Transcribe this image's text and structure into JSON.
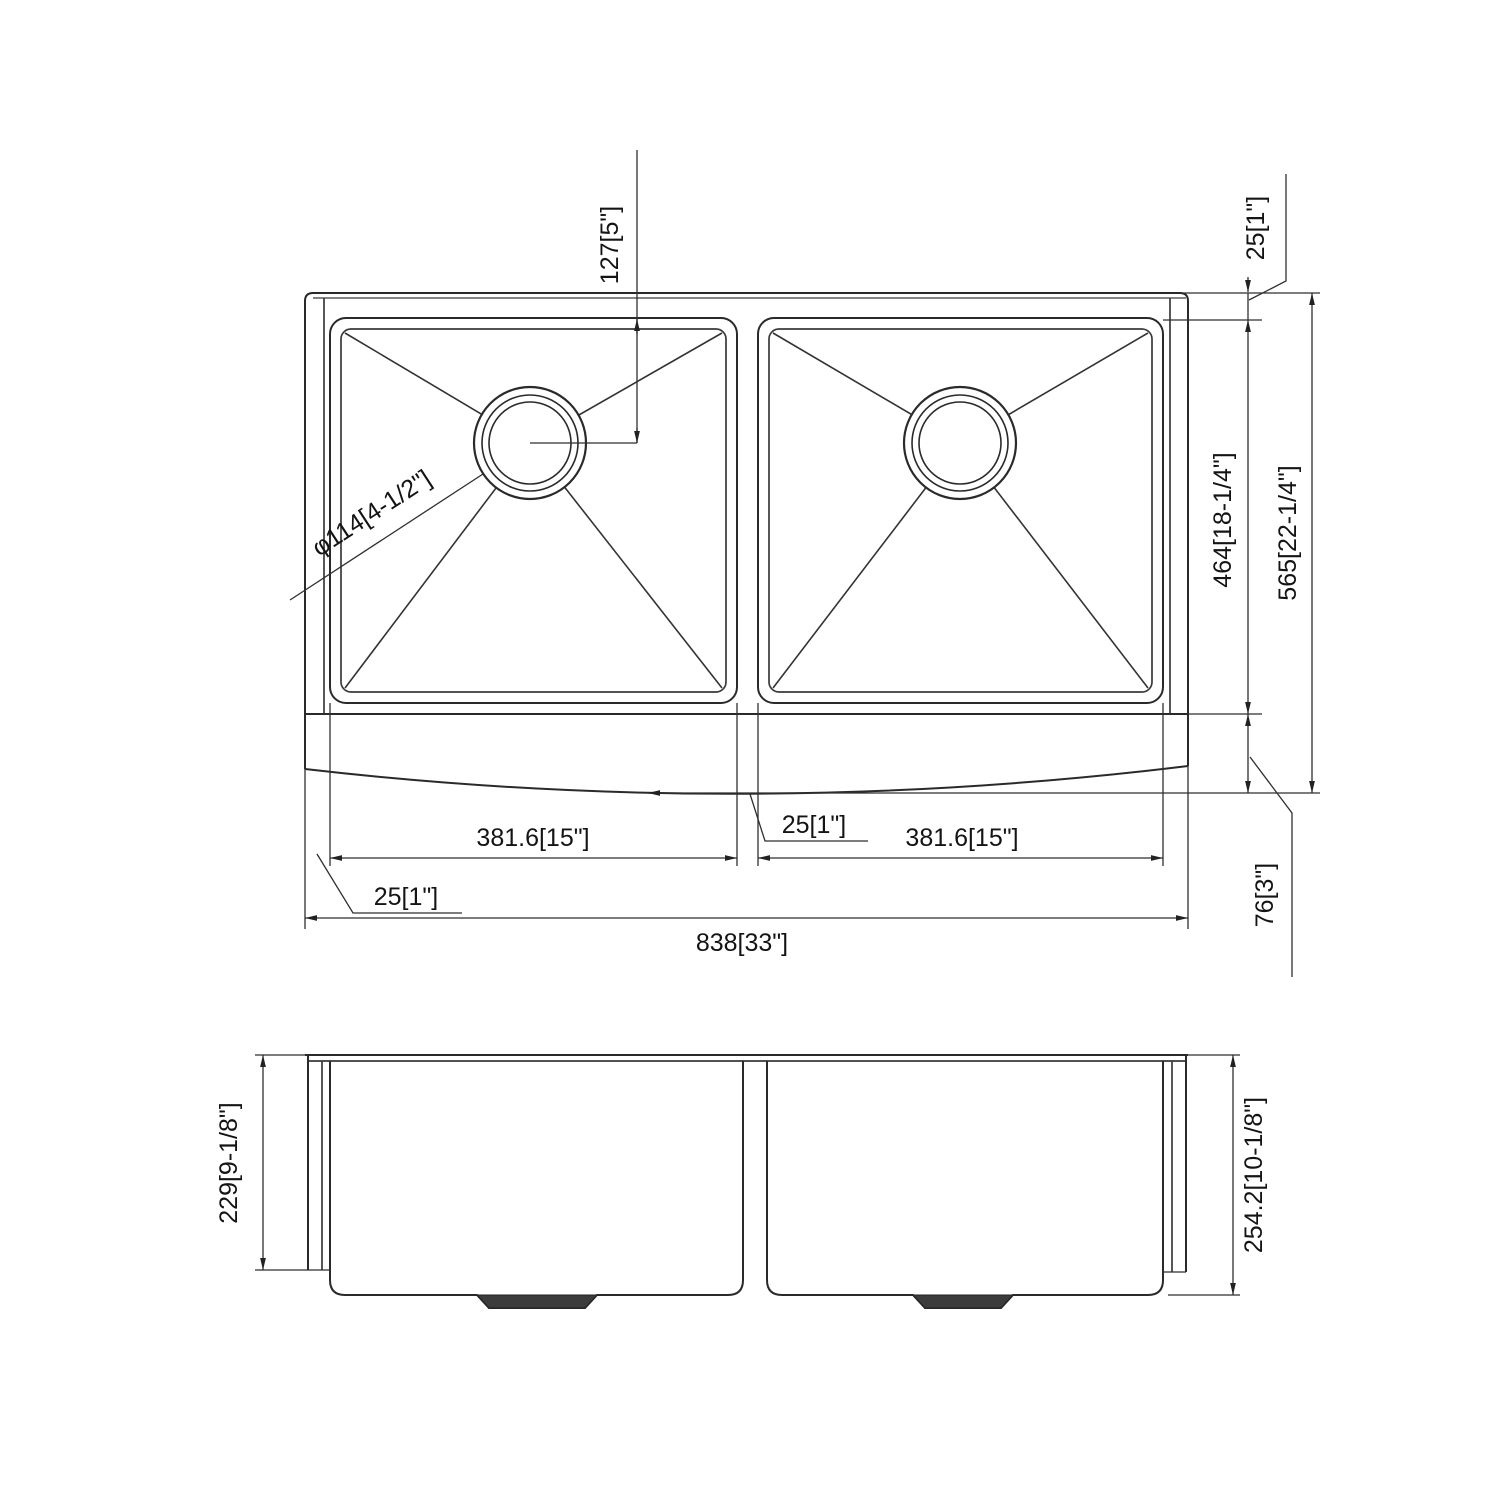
{
  "colors": {
    "line": "#2a2a2a",
    "text": "#141414",
    "background": "#ffffff"
  },
  "top_view": {
    "drain_offset": "127[5\"]",
    "rear_rim_width": "25[1\"]",
    "bowl_front_to_back": "464[18-1/4\"]",
    "overall_front_to_back": "565[22-1/4\"]",
    "apron_front": "76[3\"]",
    "drain_diameter": "φ114[4-1/2\"]",
    "left_bowl_width": "381.6[15\"]",
    "right_bowl_width": "381.6[15\"]",
    "center_divider_width": "25[1\"]",
    "side_rim_width": "25[1\"]",
    "overall_width": "838[33\"]"
  },
  "front_view": {
    "bowl_depth": "229[9-1/8\"]",
    "overall_height": "254.2[10-1/8\"]"
  }
}
